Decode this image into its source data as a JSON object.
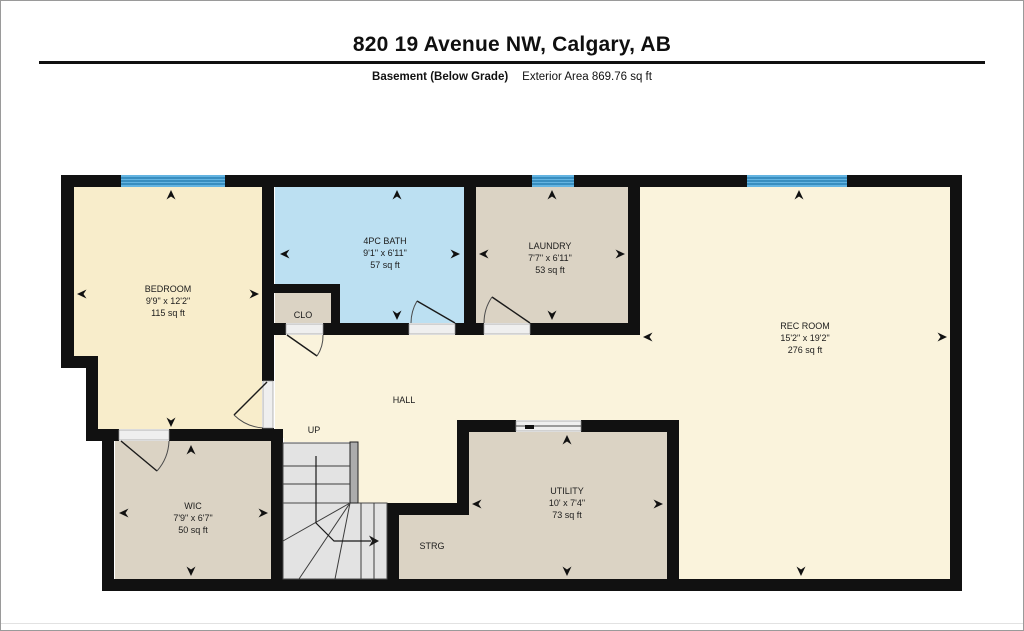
{
  "page": {
    "title": "820 19 Avenue NW, Calgary, AB",
    "floor_label": "Basement (Below Grade)",
    "area_label": "Exterior Area 869.76 sq ft"
  },
  "rooms": {
    "bedroom": {
      "name": "BEDROOM",
      "dims": "9'9\" x 12'2\"",
      "area": "115 sq ft"
    },
    "bath": {
      "name": "4PC BATH",
      "dims": "9'1\" x 6'11\"",
      "area": "57 sq ft"
    },
    "laundry": {
      "name": "LAUNDRY",
      "dims": "7'7\" x 6'11\"",
      "area": "53 sq ft"
    },
    "rec_room": {
      "name": "REC ROOM",
      "dims": "15'2\" x 19'2\"",
      "area": "276 sq ft"
    },
    "wic": {
      "name": "WIC",
      "dims": "7'9\" x 6'7\"",
      "area": "50 sq ft"
    },
    "utility": {
      "name": "UTILITY",
      "dims": "10' x 7'4\"",
      "area": "73 sq ft"
    },
    "clo": {
      "name": "CLO"
    },
    "hall": {
      "name": "HALL"
    },
    "up": {
      "name": "UP"
    },
    "strg": {
      "name": "STRG"
    }
  },
  "colors": {
    "wall": "#111111",
    "bedroom_fill": "#F8EDCB",
    "living_fill": "#FAF3DC",
    "bath_fill": "#BCE0F2",
    "tan_fill": "#DBD3C4",
    "stair_fill": "#E3E3E3",
    "railing_fill": "#ACACAC",
    "window_fill": "#64B4E1",
    "window_stripe": "#1F77AD",
    "door_gap": "#EFEFEF"
  }
}
